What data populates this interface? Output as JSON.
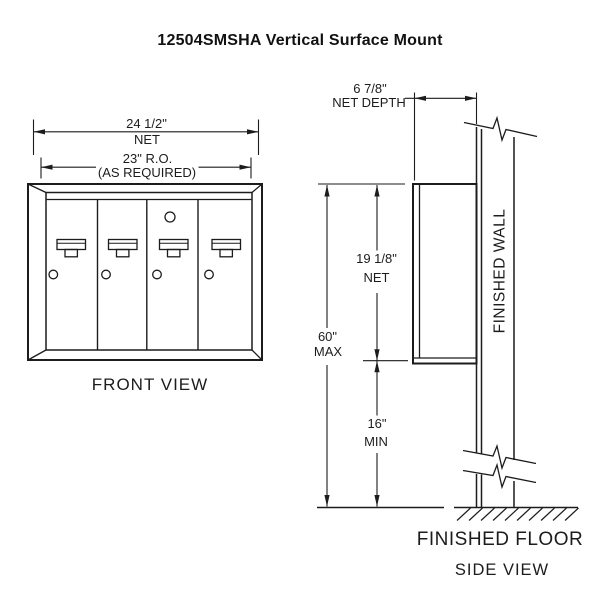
{
  "title": "12504SMSHA Vertical Surface Mount",
  "line_color": "#1c1c1c",
  "front_view": {
    "label": "FRONT VIEW",
    "door_count": 4,
    "dimensions": {
      "overall_width": {
        "value": "24 1/2\"",
        "qualifier": "NET"
      },
      "rough_opening": {
        "value": "23\" R.O.",
        "qualifier": "(AS REQUIRED)"
      }
    }
  },
  "side_view": {
    "label": "SIDE VIEW",
    "wall_label": "FINISHED WALL",
    "floor_label": "FINISHED FLOOR",
    "dimensions": {
      "net_depth": {
        "value": "6 7/8\"",
        "qualifier": "NET DEPTH"
      },
      "mount_height": {
        "value": "60\"",
        "qualifier": "MAX"
      },
      "unit_height": {
        "value": "19 1/8\"",
        "qualifier": "NET"
      },
      "floor_clearance": {
        "value": "16\"",
        "qualifier": "MIN"
      }
    }
  }
}
